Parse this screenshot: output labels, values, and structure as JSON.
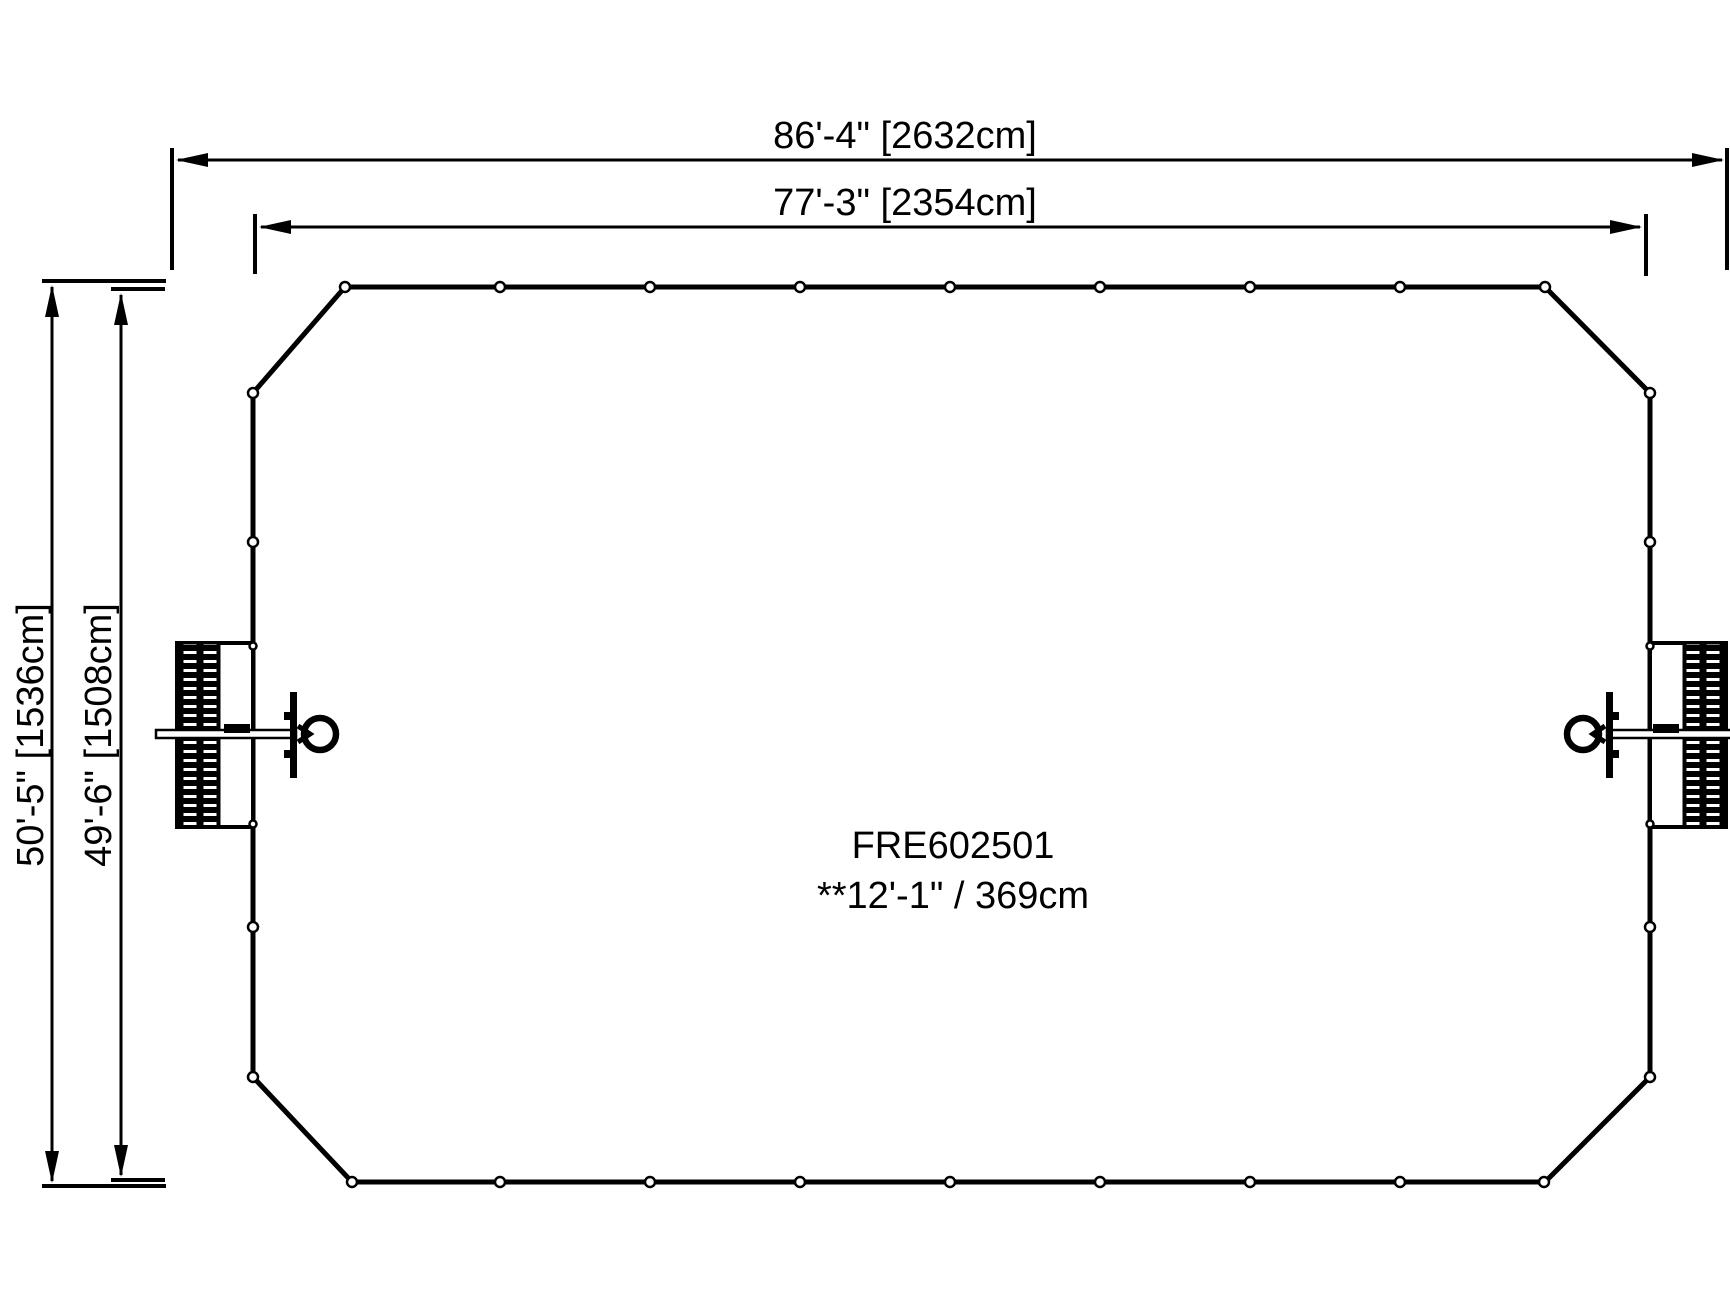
{
  "drawing": {
    "part": {
      "model": "FRE602501",
      "height_note": "**12'-1\" / 369cm"
    },
    "dimensions": {
      "outer_width": {
        "label": "86'-4\" [2632cm]"
      },
      "inner_width": {
        "label": "77'-3\" [2354cm]"
      },
      "outer_height": {
        "label": "50'-5\" [1536cm]"
      },
      "inner_height": {
        "label": "49'-6\" [1508cm]"
      }
    },
    "colors": {
      "line": "#000000",
      "background": "#ffffff"
    }
  }
}
